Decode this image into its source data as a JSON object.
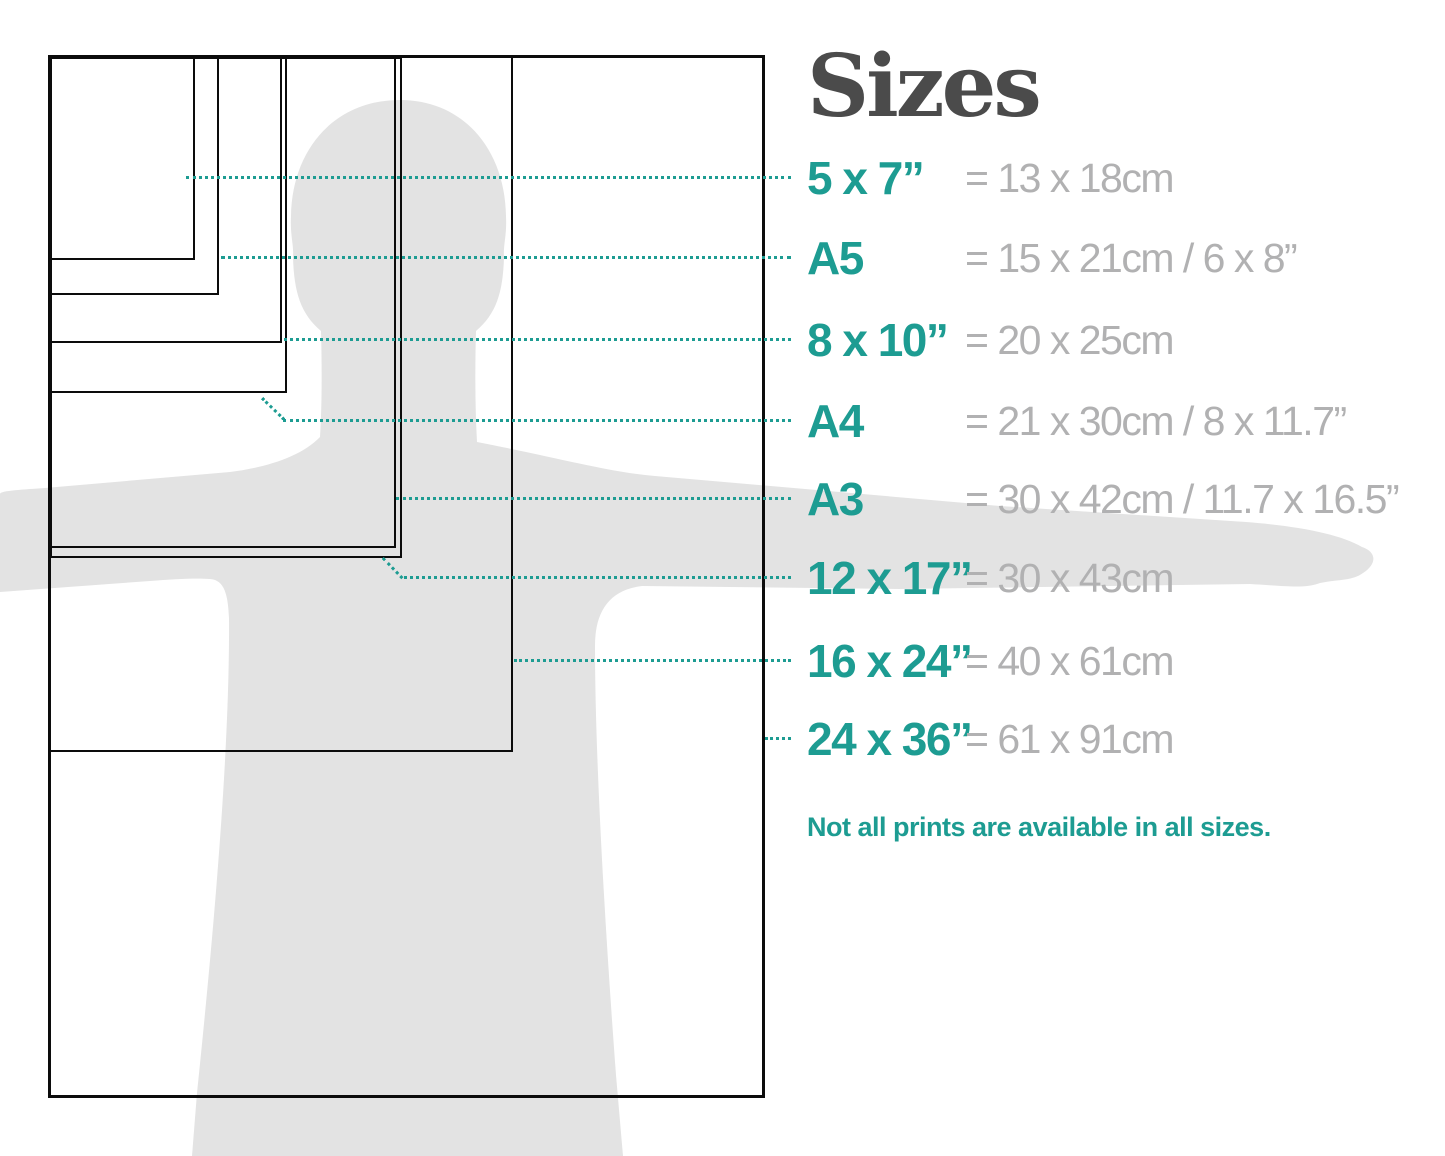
{
  "title": "Sizes",
  "note": "Not all prints are available in all sizes.",
  "colors": {
    "teal": "#1d9c92",
    "gray_text": "#b1b1b2",
    "title_gray": "#4b4b4b",
    "silhouette_gray": "#e3e3e3",
    "outline_black": "#0c0c0c"
  },
  "sizes": [
    {
      "id": "5x7",
      "label": "5 x 7”",
      "metric": "= 13 x 18cm"
    },
    {
      "id": "a5",
      "label": "A5",
      "metric": "= 15 x 21cm / 6 x 8”"
    },
    {
      "id": "8x10",
      "label": "8 x 10”",
      "metric": "= 20 x 25cm"
    },
    {
      "id": "a4",
      "label": "A4",
      "metric": "= 21 x 30cm / 8 x 11.7”"
    },
    {
      "id": "a3",
      "label": "A3",
      "metric": "= 30 x 42cm / 11.7 x 16.5”"
    },
    {
      "id": "12x17",
      "label": "12 x 17”",
      "metric": "= 30 x 43cm"
    },
    {
      "id": "16x24",
      "label": "16 x 24”",
      "metric": "= 40 x 61cm"
    },
    {
      "id": "24x36",
      "label": "24 x 36”",
      "metric": "= 61 x 91cm"
    }
  ]
}
